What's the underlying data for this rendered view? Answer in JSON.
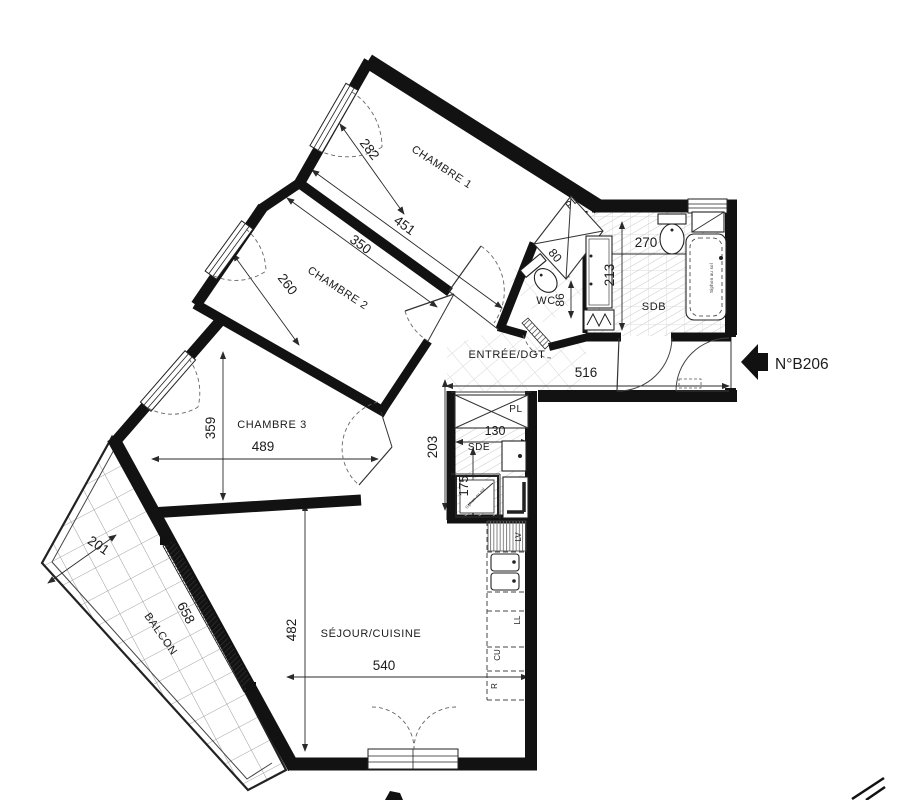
{
  "unit_label": "N°B206",
  "rooms": {
    "chambre1": {
      "name": "CHAMBRE 1",
      "dim_depth": "282",
      "dim_width": "451"
    },
    "chambre2": {
      "name": "CHAMBRE 2",
      "dim_width": "350",
      "dim_depth": "260"
    },
    "chambre3": {
      "name": "CHAMBRE 3",
      "dim_depth": "359",
      "dim_width": "489"
    },
    "entree": {
      "name": "ENTRÉE/DGT",
      "dim_width": "516",
      "dim_depth": "203"
    },
    "wc": {
      "name": "WC",
      "dim_width": "80",
      "dim_depth": "86"
    },
    "sdb": {
      "name": "SDB",
      "dim_width": "270",
      "dim_depth": "213"
    },
    "sde": {
      "name": "SDE",
      "dim_width": "130",
      "dim_depth": "175"
    },
    "sejour": {
      "name": "SÉJOUR/CUISINE",
      "dim_depth": "482",
      "dim_width": "540"
    },
    "balcon": {
      "name": "BALCON",
      "dim_depth": "201",
      "dim_width": "658"
    }
  },
  "closets": {
    "pl_entree": "PL",
    "pl_hall": "PL"
  },
  "appliances": {
    "dishwasher": "LV",
    "washer": "LL",
    "cooker": "CU",
    "fridge": "R"
  },
  "notes": {
    "floor_drain_bath": "Siphon au sol",
    "floor_drain_shower": "Siphon au sol"
  }
}
